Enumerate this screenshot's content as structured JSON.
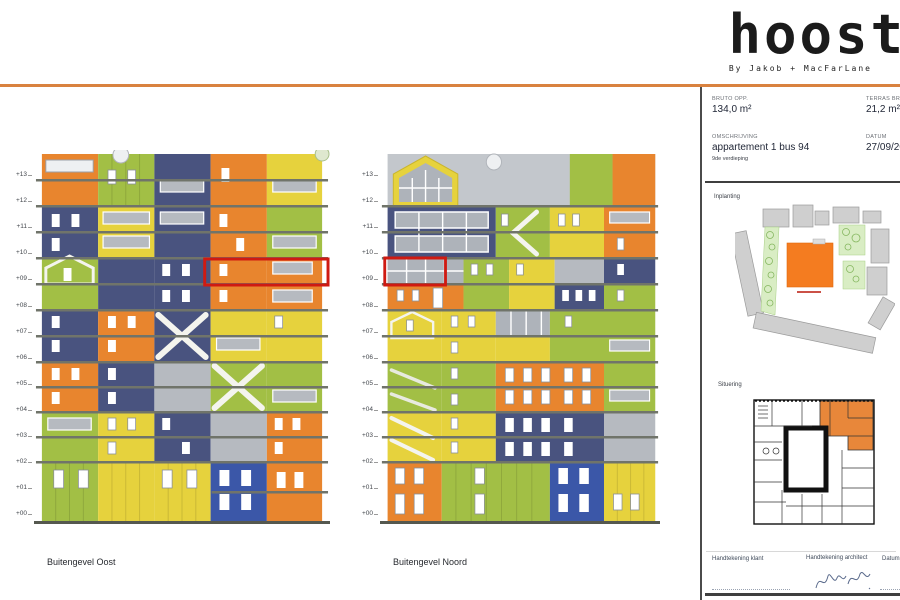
{
  "sheet": {
    "logo_text": "hoost",
    "byline": "By Jakob + MacFarLane"
  },
  "titleblock": {
    "bruto": {
      "label": "BRUTO OPP.",
      "value": "134,0 m²"
    },
    "terras": {
      "label": "TERRAS BRUT",
      "value": "21,2 m²"
    },
    "omschrijving": {
      "label": "OMSCHRIJVING",
      "value": "appartement 1 bus 94",
      "sub": "9de verdieping"
    },
    "datum": {
      "label": "DATUM",
      "value": "27/09/20"
    },
    "inplanting_label": "Inplanting",
    "situering_label": "Situering",
    "signatures": {
      "klant_label": "Handtekening klant",
      "architect_label": "Handtekening architect",
      "datum_label": "Datum"
    }
  },
  "elevations": {
    "floor_labels": [
      "+13",
      "+12",
      "+11",
      "+10",
      "+09",
      "+08",
      "+07",
      "+06",
      "+05",
      "+04",
      "+03",
      "+02",
      "+01",
      "+00"
    ],
    "oost_caption": "Buitengevel Oost",
    "noord_caption": "Buitengevel Noord"
  },
  "colors": {
    "accent_rule_orange": "#d9823f",
    "facade_orange": "#e8852e",
    "facade_green": "#a2bf45",
    "facade_yellow": "#e6d23d",
    "facade_navy": "#49537f",
    "facade_blue": "#3b57a8",
    "window_gray": "#b6bac0",
    "highlight_red": "#cf1a12",
    "site_plan_orange": "#f47c20",
    "site_plan_green": "#d9edc4"
  }
}
